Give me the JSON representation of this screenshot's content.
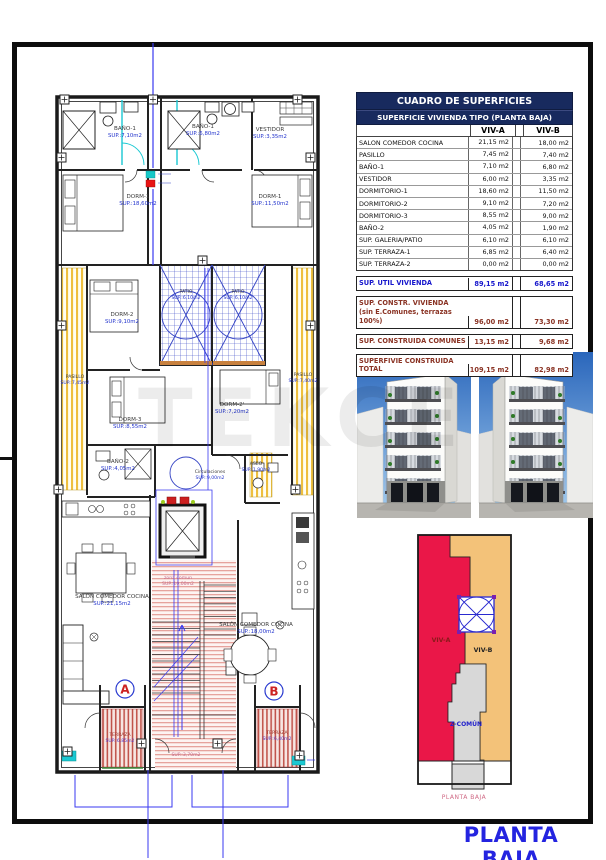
{
  "page": {
    "title": "PLANTA BAJA",
    "watermark": "TEKCE"
  },
  "table": {
    "title": "CUADRO DE SUPERFICIES",
    "subtitle": "SUPERFICIE VIVIENDA TIPO  (PLANTA BAJA)",
    "columns": {
      "a": "VIV-A",
      "b": "VIV-B"
    },
    "rows": [
      {
        "label": "SALON COMEDOR COCINA",
        "a": "21,15 m2",
        "b": "18,00 m2"
      },
      {
        "label": "PASILLO",
        "a": "7,45 m2",
        "b": "7,40 m2"
      },
      {
        "label": "BAÑO-1",
        "a": "7,10 m2",
        "b": "6,80 m2"
      },
      {
        "label": "VESTIDOR",
        "a": "6,00 m2",
        "b": "3,35 m2"
      },
      {
        "label": "DORMITORIO-1",
        "a": "18,60 m2",
        "b": "11,50 m2"
      },
      {
        "label": "DORMITORIO-2",
        "a": "9,10 m2",
        "b": "7,20 m2"
      },
      {
        "label": "DORMITORIO-3",
        "a": "8,55 m2",
        "b": "9,00 m2"
      },
      {
        "label": "BAÑO-2",
        "a": "4,05 m2",
        "b": "1,90 m2"
      },
      {
        "label": "SUP. GALERIA/PATIO",
        "a": "6,10 m2",
        "b": "6,10 m2"
      },
      {
        "label": "SUP. TERRAZA-1",
        "a": "6,85 m2",
        "b": "6,40 m2"
      },
      {
        "label": "SUP. TERRAZA-2",
        "a": "0,00 m2",
        "b": "0,00 m2"
      }
    ],
    "summary_util": {
      "label": "SUP. UTIL VIVIENDA",
      "a": "89,15 m2",
      "b": "68,65 m2"
    },
    "summary_constr": {
      "label": "SUP. CONSTR. VIVIENDA",
      "label2": "(sin E.Comunes, terrazas 100%)",
      "a": "96,00 m2",
      "b": "73,30 m2"
    },
    "summary_comunes": {
      "label": "SUP. CONSTRUIDA COMUNES",
      "a": "13,15 m2",
      "b": "9,68 m2"
    },
    "summary_total": {
      "label": "SUPERFIVIE CONSTRUIDA",
      "label2": "TOTAL",
      "a": "109,15 m2",
      "b": "82,98 m2"
    }
  },
  "floor_plan": {
    "marker_a": "A",
    "marker_b": "B",
    "rooms": [
      {
        "name": "BAÑO-1",
        "value": "SUP.:7,10m2"
      },
      {
        "name": "BAÑO-1",
        "value": "SUP.:6,80m2"
      },
      {
        "name": "VESTIDOR",
        "value": "SUP.:3,35m2"
      },
      {
        "name": "DORM-1",
        "value": "SUP.:18,60m2"
      },
      {
        "name": "DORM-1",
        "value": "SUP.:11,50m2"
      },
      {
        "name": "DORM-2",
        "value": "SUP.:9,10m2"
      },
      {
        "name": "PATIO",
        "value": "SUP.:6,10m2"
      },
      {
        "name": "PATIO",
        "value": "SUP.:6,10m2"
      },
      {
        "name": "PASILLO",
        "value": "SUP.:7,45m2"
      },
      {
        "name": "PASILLO",
        "value": "SUP.:7,40m2"
      },
      {
        "name": "DORM-3",
        "value": "SUP.:8,55m2"
      },
      {
        "name": "DORM-2'",
        "value": "SUP.:7,20m2"
      },
      {
        "name": "BAÑO-2",
        "value": "SUP.:4,05m2"
      },
      {
        "name": "ASEO",
        "value": "SUP.:1,90m2"
      },
      {
        "name": "Circulaciones",
        "value": "SUP.:9,00m2"
      },
      {
        "name": "zona comun",
        "value": "SUP.:10,00m2"
      },
      {
        "name": "SALÓN COMEDOR COCINA",
        "value": "SUP.:21,15m2"
      },
      {
        "name": "SALÓN COMEDOR COCINA",
        "value": "SUP.:18,00m2"
      },
      {
        "name": "TERRAZA",
        "value": "SUP.:6,85m2"
      },
      {
        "name": "TERRAZA",
        "value": "SUP.:6,40m2"
      },
      {
        "name": "",
        "value": "SUP.:3,70m2"
      }
    ]
  },
  "diagram": {
    "viv_a": "VIV-A",
    "viv_b": "VIV-B",
    "comun": "Z-COMÚN",
    "caption": "PLANTA BAJA",
    "colors": {
      "viv_a": "#ea1748",
      "viv_b": "#f3c279",
      "comun": "#d8d8d8"
    }
  }
}
